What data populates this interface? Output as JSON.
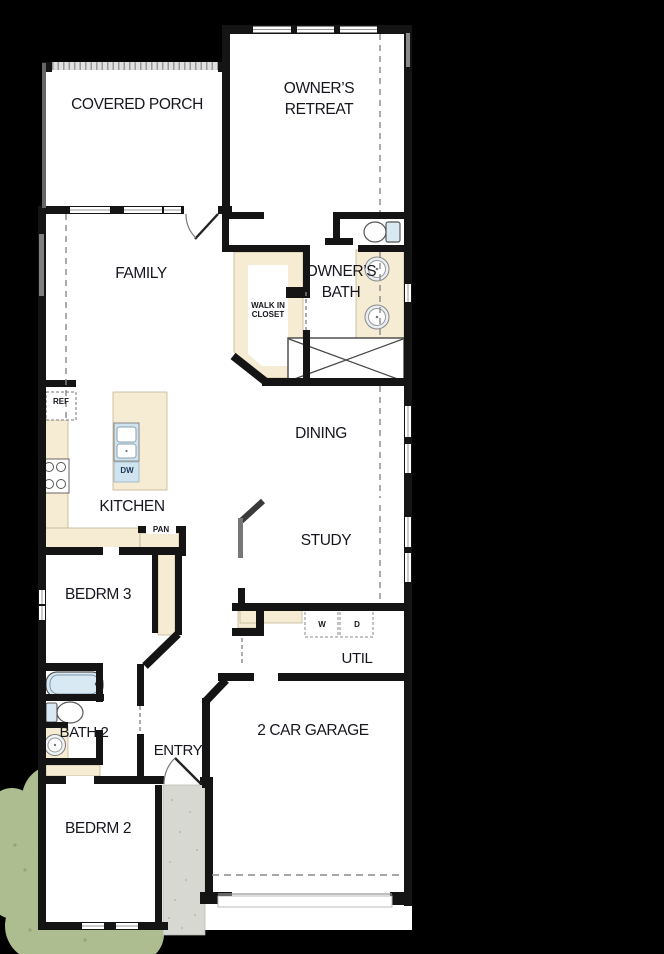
{
  "plan": {
    "type": "single-story floor plan",
    "rooms": {
      "covered_porch": "COVERED PORCH",
      "owners_retreat": "OWNER’S RETREAT",
      "family": "FAMILY",
      "owners_bath": "OWNER’S BATH",
      "walk_in_closet": "WALK IN CLOSET",
      "dining": "DINING",
      "kitchen": "KITCHEN",
      "study": "STUDY",
      "bedrm3": "BEDRM 3",
      "util": "UTIL",
      "bath2": "BATH 2",
      "entry": "ENTRY",
      "garage": "2 CAR GARAGE",
      "bedrm2": "BEDRM 2"
    },
    "appliances": {
      "refrigerator": "REF",
      "dishwasher": "DW",
      "pantry": "PAN",
      "washer": "W",
      "dryer": "D"
    },
    "colors": {
      "background": "#000000",
      "floor": "#ffffff",
      "wall": "#141414",
      "casework_tan": "#f6ecd3",
      "fixture_blue": "#d9e9f4",
      "landscape_green": "#adbd8f",
      "walkway_gray": "#d8d8d3"
    }
  }
}
